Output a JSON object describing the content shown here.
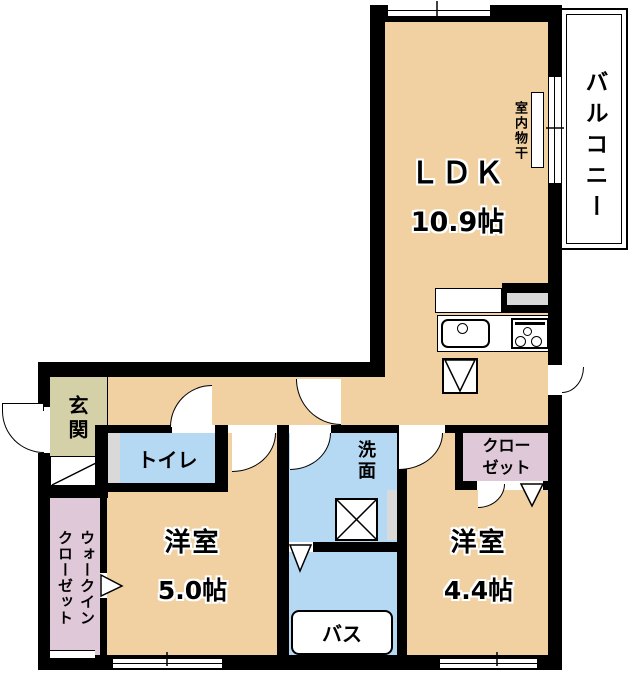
{
  "rooms": {
    "ldk": {
      "label": "ＬＤＫ",
      "size": "10.9帖"
    },
    "balcony": {
      "label": "バルコニー"
    },
    "indoor_laundry": {
      "label": "室内物干"
    },
    "entrance": {
      "label": "玄関"
    },
    "toilet": {
      "label": "トイレ"
    },
    "washroom": {
      "label": "洗面"
    },
    "bath": {
      "label": "バス"
    },
    "bedroom_50": {
      "label": "洋室",
      "size": "5.0帖"
    },
    "bedroom_44": {
      "label": "洋室",
      "size": "4.4帖"
    },
    "closet": {
      "label": "クロー\nゼット"
    },
    "walk_in_closet": {
      "label": "ウォークイン\nクローゼット"
    }
  },
  "colors": {
    "floor_tan": "#F1D1A1",
    "wet_area_blue": "#B5D8F3",
    "closet_pink": "#DFC8D8",
    "entrance_olive": "#D4D1A8",
    "wall_black": "#000000",
    "pipe_space_gray": "#D9D9D9",
    "background_white": "#FFFFFF"
  }
}
